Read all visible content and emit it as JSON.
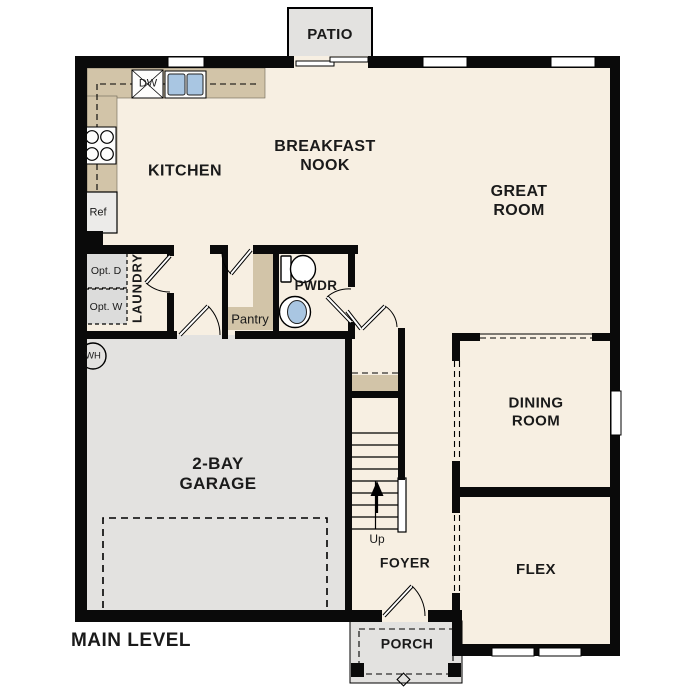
{
  "plan_title": "MAIN LEVEL",
  "rooms": {
    "patio": "PATIO",
    "kitchen": "KITCHEN",
    "breakfast_nook": "BREAKFAST NOOK",
    "great_room": "GREAT ROOM",
    "laundry": "LAUNDRY",
    "pantry": "Pantry",
    "powder": "PWDR",
    "garage": "2-BAY GARAGE",
    "dining": "DINING ROOM",
    "flex": "FLEX",
    "foyer": "FOYER",
    "porch": "PORCH"
  },
  "labels": {
    "dishwasher": "DW",
    "refrigerator": "Ref",
    "optional_dryer": "Opt. D",
    "optional_washer": "Opt. W",
    "water_heater": "WH",
    "stairs_up": "Up"
  },
  "colors": {
    "floor": "#f7efe2",
    "paved": "#e3e2e0",
    "counter": "#d2c4a8",
    "blue": "#a9c6e2",
    "wall": "#0a0a0a",
    "optbox": "#dcdcdb",
    "text": "#1a1a1a"
  }
}
